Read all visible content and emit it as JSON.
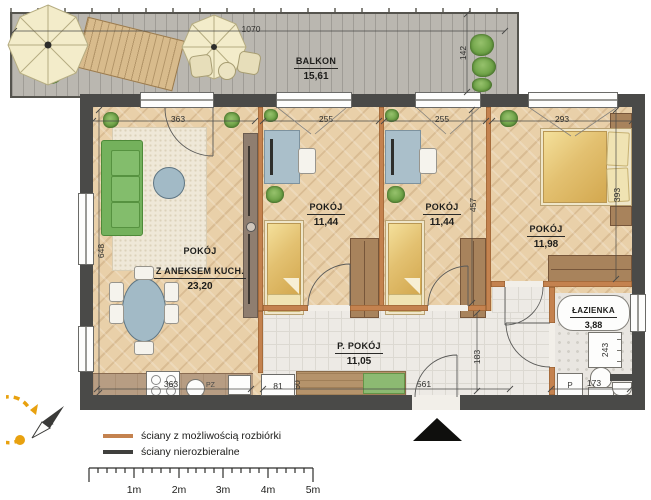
{
  "balcony": {
    "name": "BALKON",
    "area": "15,61",
    "dim_length": "1070",
    "dim_depth": "142"
  },
  "living": {
    "name": "POKÓJ",
    "name2": "Z ANEKSEM KUCH.",
    "area": "23,20",
    "dim_window": "363",
    "dim_side": "648",
    "dim_kitchen": "363",
    "kitchen_label": "PZ"
  },
  "room2": {
    "name": "POKÓJ",
    "area": "11,44",
    "dim_window": "255"
  },
  "room3": {
    "name": "POKÓJ",
    "area": "11,44",
    "dim_window": "255",
    "dim_side": "457"
  },
  "bedroom": {
    "name": "POKÓJ",
    "area": "11,98",
    "dim_window": "293",
    "dim_side": "393"
  },
  "hall": {
    "name": "P. POKÓJ",
    "area": "11,05",
    "dim_length": "561",
    "dim_side": "183",
    "dim_window": "81",
    "dim_depth": "60"
  },
  "bath": {
    "name": "ŁAZIENKA",
    "area": "3,88",
    "dim_radiator": "243",
    "dim_width": "173",
    "washer_label": "P"
  },
  "legend": {
    "items": [
      {
        "label": "ściany z możliwością rozbiórki",
        "color": "#c4824f"
      },
      {
        "label": "ściany nierozbieralne",
        "color": "#3f3f3d"
      }
    ]
  },
  "scalebar": {
    "labels": [
      "1m",
      "2m",
      "3m",
      "4m",
      "5m"
    ]
  },
  "compass": {
    "label": "N"
  }
}
